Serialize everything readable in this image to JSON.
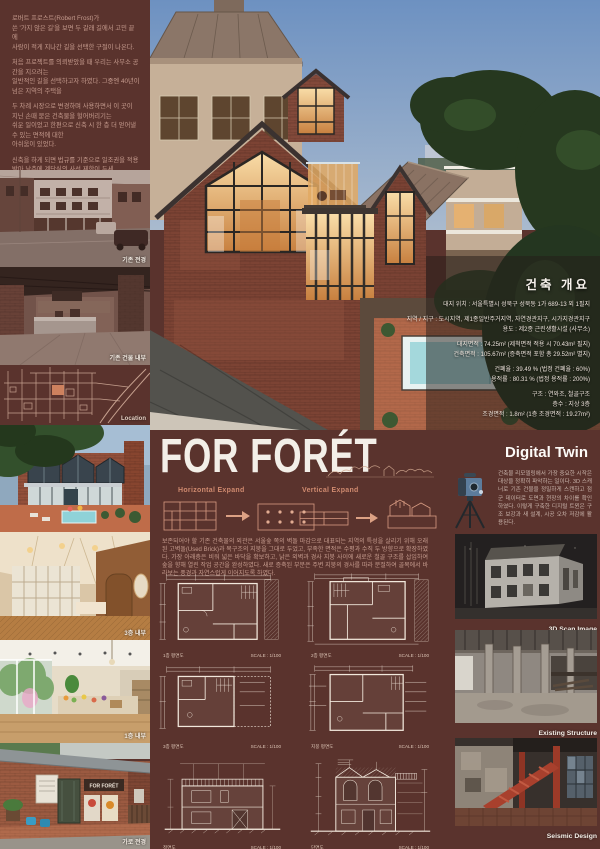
{
  "intro": {
    "paragraphs": [
      "로버트 프로스트(Robert Frost)가\n쓴 '가지 않은 길'을 보면 두 갈래 길에서 고민 끝에\n사람이 적게 지나간 길을 선택한 구절이 나온다.",
      "처음 프로젝트를 의뢰받았을 때 우리는 사무소 공간을 지으려는\n일반적인 길을 선택하고자 하였다. 그중엔 40년이 넘은 지역의 주택을",
      "두 차례 시장으로 변경하며 사용하면서 이 곳이 지닌 손때 묻은 건축물을 헐어버리기는\n쉬운 일이었고 한편으로 신축 시 한 층 더 얻어낼 수 있는 면적에 대한\n아쉬움이 있었다.",
      "신축을 하게 되면 법규를 기준으로 일조권을 적용받아 남측에 계단식의 사선 제한이 두세\n층 생기고, 그렇게 되면 서울숲으로 향한 조망이 사라지게 된다.",
      "고민 끝에 건축주가 선택할 수 있는 두 개의 길 - 용적을 최대한 확보할 수 있는\n신축 계획과 낡은 외벽을 온전히 두면서 공간을 확보하는 증축 계획 - 을 제안하였고,\n우리는 왕래가 잦지 않은 길을 걷기 시작하였다."
    ]
  },
  "overview": {
    "title": "건축 개요",
    "lines": [
      "대지 위치 : 서울특별시 성북구 성북동 1가 689-13 외 1필지",
      "지역 / 지구 : 도시지역, 제1종일반주거지역, 자연경관지구, 시가지경관지구",
      "용도 : 제2종 근린생활시설 (사무소)",
      "대지면적 : 74.25m² (제척면적 적용 시 70.43m² 필지)",
      "건축면적 : 105.67m² (증축면적 포함 총 29.52m² 별지)",
      "건폐율 : 39.49 % (법정 건폐율 : 60%)",
      "용적률 : 80.31 % (법정 용적률 : 200%)",
      "구조 : 연와조, 철골구조",
      "층수 : 지상 3층",
      "조경면적 : 1.8m² (1층 조경면적 : 19.27m²)"
    ]
  },
  "left": {
    "captions": [
      "기존 전경",
      "기존 건물 내부",
      "Location",
      "3층 내부",
      "1층 내부",
      "가로 전경"
    ],
    "storefront_sign": "FOR FORÉT"
  },
  "center": {
    "title": "FOR FORÉT",
    "h_label": "Horizontal Expand",
    "v_label": "Vertical Expand",
    "paragraph": "보존되어야 할 기존 건축물의 외관은 서울숲 쪽의 벽돌 마감으로 대표되는 지역의 특성을 살리기 위해 오래된 고벽돌(Used Brick)과 목구조의 지붕을 그대로 두었고, 부족한 면적은 수평과 수직 두 방향으로 확장하였다. 가장 아래층은 비워 넓은 바닥을 확보하고, 낡은 외벽과 경사 지붕 사이에 새로운 철골 구조를 삽입하여 숲을 향해 열린 작업 공간을 완성하였다. 새로 증축된 부분은 주변 지붕의 경사를 따라 분절하여 골목에서 바라보는 풍경과 자연스럽게 이어지도록 하였다.",
    "plans": [
      "1층 평면도",
      "2층 평면도",
      "3층 평면도",
      "지붕 평면도"
    ],
    "plan_scale": "SCALE : 1/100",
    "elevations": [
      "정면도",
      "단면도"
    ]
  },
  "digital_twin": {
    "title": "Digital Twin",
    "paragraph": "건축물 리모델링에서 가장 중요한 시작은 대상을 정확히 파악하는 일이다. 3D 스캐너로 기존 건물을 정밀하게 스캔하고 점군 데이터로 도면과 현장의 차이를 확인하였다. 이렇게 구축한 디지털 트윈은 구조 보강과 새 설계, 시공 오차 저감에 활용된다.",
    "captions": [
      "3D Scan Image",
      "Existing Structure",
      "Seismic Design"
    ]
  },
  "colors": {
    "background": "#5a332d",
    "accent": "#cf8a6f",
    "title_white": "#f3efe8"
  }
}
